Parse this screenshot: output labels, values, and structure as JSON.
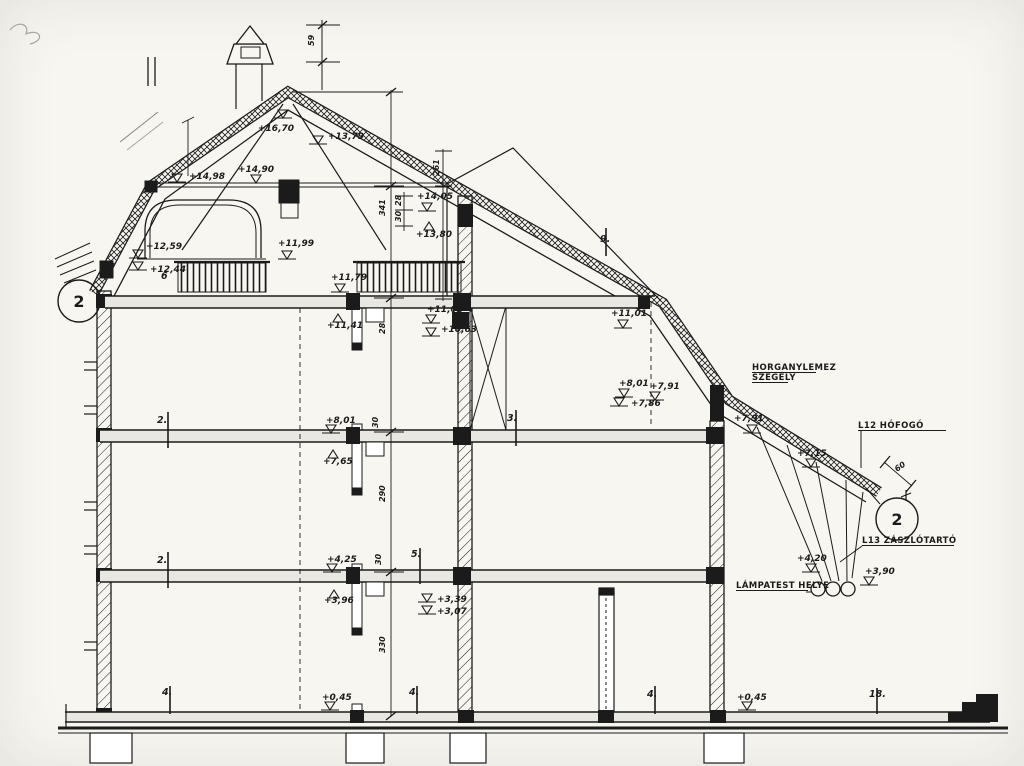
{
  "document": {
    "type": "scanned architectural section drawing",
    "language": "Hungarian",
    "ink_color": "#1b1b1b",
    "paper_color": "#f7f6f1"
  },
  "drawing": {
    "detail_bubbles": [
      {
        "label": "2",
        "x": 79,
        "y": 301
      },
      {
        "label": "2",
        "x": 897,
        "y": 519
      }
    ],
    "notes": [
      {
        "text": "HORGANYLEMEZ",
        "x": 752,
        "y": 370,
        "w": 64
      },
      {
        "text": "SZEGÉLY",
        "x": 752,
        "y": 380,
        "w": 36
      },
      {
        "text": "L12 HÓFOGÓ",
        "x": 858,
        "y": 428,
        "w": 88
      },
      {
        "text": "L13 ZÁSZLÓTARTÓ",
        "x": 862,
        "y": 543,
        "w": 92
      },
      {
        "text": "LÁMPATEST HELYE",
        "x": 736,
        "y": 588,
        "w": 72
      }
    ],
    "elevation_markers": [
      {
        "text": "+16,70",
        "tx": 258,
        "ty": 131,
        "mx": 283,
        "my": 116,
        "dir": "down"
      },
      {
        "text": "+13,79",
        "tx": 328,
        "ty": 139,
        "mx": 318,
        "my": 142,
        "dir": "down"
      },
      {
        "text": "+14,90",
        "tx": 238,
        "ty": 172,
        "mx": 256,
        "my": 181,
        "dir": "down"
      },
      {
        "text": "+14,98",
        "tx": 189,
        "ty": 179,
        "mx": 177,
        "my": 180,
        "dir": "down"
      },
      {
        "text": "+14,05",
        "tx": 417,
        "ty": 199,
        "mx": 427,
        "my": 209,
        "dir": "down"
      },
      {
        "text": "+13,80",
        "tx": 416,
        "ty": 237,
        "mx": 429,
        "my": 224,
        "dir": "up"
      },
      {
        "text": "+12,59",
        "tx": 146,
        "ty": 249,
        "mx": 138,
        "my": 256,
        "dir": "down"
      },
      {
        "text": "+12,44",
        "tx": 150,
        "ty": 272,
        "mx": 138,
        "my": 268,
        "dir": "down"
      },
      {
        "text": "+11,99",
        "tx": 278,
        "ty": 246,
        "mx": 287,
        "my": 257,
        "dir": "down"
      },
      {
        "text": "+11,79",
        "tx": 331,
        "ty": 280,
        "mx": 340,
        "my": 290,
        "dir": "down"
      },
      {
        "text": "+11,41",
        "tx": 327,
        "ty": 328,
        "mx": 338,
        "my": 316,
        "dir": "up"
      },
      {
        "text": "+11,03",
        "tx": 427,
        "ty": 312,
        "mx": 431,
        "my": 321,
        "dir": "down"
      },
      {
        "text": "+10,63",
        "tx": 441,
        "ty": 332,
        "mx": 431,
        "my": 334,
        "dir": "down"
      },
      {
        "text": "+11,01",
        "tx": 611,
        "ty": 316,
        "mx": 623,
        "my": 326,
        "dir": "down"
      },
      {
        "text": "+8,01",
        "tx": 619,
        "ty": 386,
        "mx": 624,
        "my": 395,
        "dir": "down"
      },
      {
        "text": "+7,86",
        "tx": 631,
        "ty": 406,
        "mx": 619,
        "my": 404,
        "dir": "down"
      },
      {
        "text": "+7,91",
        "tx": 650,
        "ty": 389,
        "mx": 655,
        "my": 398,
        "dir": "down"
      },
      {
        "text": "+7,91",
        "tx": 734,
        "ty": 421,
        "mx": 752,
        "my": 431,
        "dir": "down"
      },
      {
        "text": "+7,15",
        "tx": 797,
        "ty": 456,
        "mx": 811,
        "my": 465,
        "dir": "down"
      },
      {
        "text": "+4,20",
        "tx": 797,
        "ty": 561,
        "mx": 811,
        "my": 570,
        "dir": "down"
      },
      {
        "text": "+3,90",
        "tx": 865,
        "ty": 574,
        "mx": 869,
        "my": 583,
        "dir": "down"
      },
      {
        "text": "+8,01",
        "tx": 326,
        "ty": 423,
        "mx": 331,
        "my": 431,
        "dir": "down"
      },
      {
        "text": "+7,65",
        "tx": 323,
        "ty": 464,
        "mx": 333,
        "my": 452,
        "dir": "up"
      },
      {
        "text": "+4,25",
        "tx": 327,
        "ty": 562,
        "mx": 332,
        "my": 570,
        "dir": "down"
      },
      {
        "text": "+3,96",
        "tx": 324,
        "ty": 603,
        "mx": 334,
        "my": 592,
        "dir": "up"
      },
      {
        "text": "+3,39",
        "tx": 437,
        "ty": 602,
        "mx": 427,
        "my": 600,
        "dir": "down"
      },
      {
        "text": "+3,07",
        "tx": 437,
        "ty": 614,
        "mx": 427,
        "my": 612,
        "dir": "down"
      },
      {
        "text": "+0,45",
        "tx": 322,
        "ty": 700,
        "mx": 330,
        "my": 708,
        "dir": "down"
      },
      {
        "text": "+0,45",
        "tx": 737,
        "ty": 700,
        "mx": 747,
        "my": 708,
        "dir": "down"
      }
    ],
    "ref_numbers": [
      {
        "text": "6",
        "x": 161,
        "y": 279
      },
      {
        "text": "2.",
        "x": 157,
        "y": 423
      },
      {
        "text": "2.",
        "x": 157,
        "y": 563
      },
      {
        "text": "3.",
        "x": 507,
        "y": 421
      },
      {
        "text": "5.",
        "x": 411,
        "y": 557
      },
      {
        "text": "9.",
        "x": 600,
        "y": 242
      },
      {
        "text": "4.",
        "x": 162,
        "y": 695
      },
      {
        "text": "4.",
        "x": 409,
        "y": 695
      },
      {
        "text": "4.",
        "x": 647,
        "y": 697
      },
      {
        "text": "18.",
        "x": 869,
        "y": 697
      }
    ],
    "dim_labels": [
      {
        "text": "59",
        "x": 314,
        "y": 46,
        "rot": -90
      },
      {
        "text": "341",
        "x": 385,
        "y": 216,
        "rot": -90
      },
      {
        "text": "28",
        "x": 401,
        "y": 206,
        "rot": -90
      },
      {
        "text": "30",
        "x": 401,
        "y": 222,
        "rot": -90
      },
      {
        "text": "261",
        "x": 439,
        "y": 176,
        "rot": -90
      },
      {
        "text": "28",
        "x": 385,
        "y": 334,
        "rot": -90
      },
      {
        "text": "30",
        "x": 378,
        "y": 428,
        "rot": -90
      },
      {
        "text": "30",
        "x": 381,
        "y": 565,
        "rot": -90
      },
      {
        "text": "290",
        "x": 385,
        "y": 502,
        "rot": -90
      },
      {
        "text": "330",
        "x": 385,
        "y": 653,
        "rot": -90
      },
      {
        "text": "60",
        "x": 897,
        "y": 472,
        "rot": -35
      }
    ]
  }
}
